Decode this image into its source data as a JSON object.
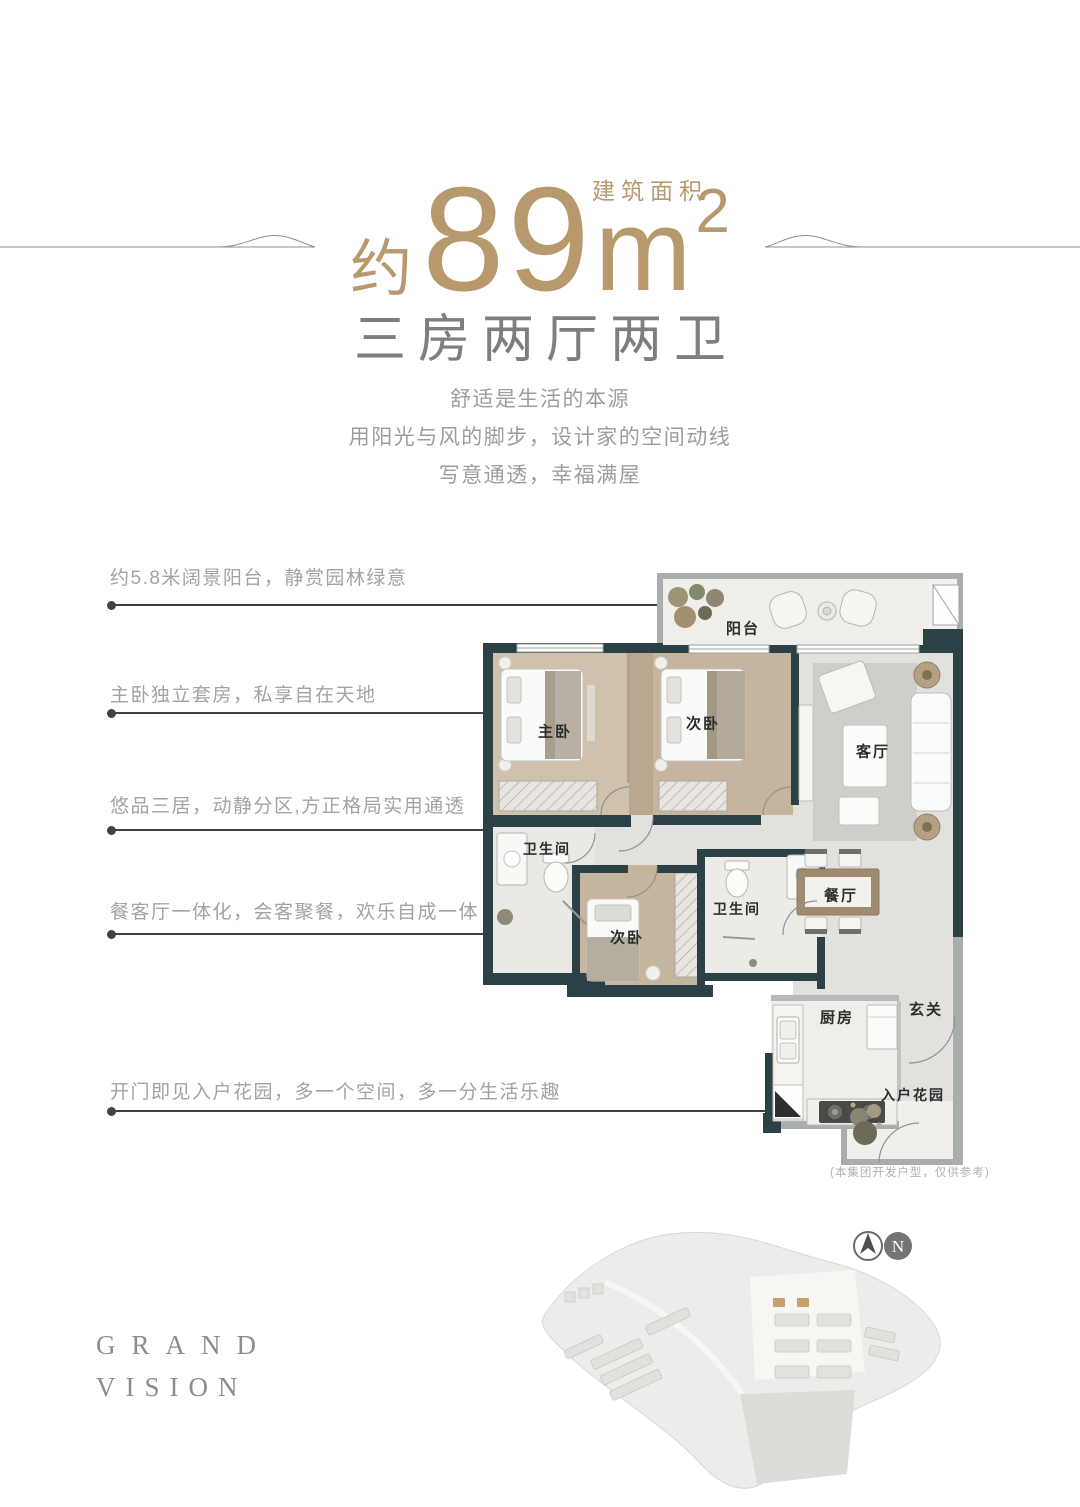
{
  "header": {
    "area_label": "建筑面积",
    "area_prefix": "约",
    "area_number": "89",
    "area_unit": "m",
    "area_sup": "2",
    "title": "三房两厅两卫",
    "subtitle_lines": [
      "舒适是生活的本源",
      "用阳光与风的脚步，设计家的空间动线",
      "写意通透，幸福满屋"
    ]
  },
  "callouts": [
    {
      "text": "约5.8米阔景阳台，静赏园林绿意"
    },
    {
      "text": "主卧独立套房，私享自在天地"
    },
    {
      "text": "悠品三居，动静分区,方正格局实用通透"
    },
    {
      "text": "餐客厅一体化，会客聚餐，欢乐自成一体"
    },
    {
      "text": "开门即见入户花园，多一个空间，多一分生活乐趣"
    }
  ],
  "floorplan": {
    "rooms": [
      {
        "label": "阳台"
      },
      {
        "label": "主卧"
      },
      {
        "label": "次卧"
      },
      {
        "label": "客厅"
      },
      {
        "label": "卫生间"
      },
      {
        "label": "次卧"
      },
      {
        "label": "卫生间"
      },
      {
        "label": "餐厅"
      },
      {
        "label": "厨房"
      },
      {
        "label": "玄关"
      },
      {
        "label": "入户花园"
      }
    ],
    "note": "(本集团开发户型，仅供参考)"
  },
  "footer": {
    "brand_line1": "GRAND",
    "brand_line2": "VISION",
    "compass_n": "N"
  },
  "colors": {
    "gold": "#b7996d",
    "heading_gray": "#7e7e7e",
    "body_gray": "#9d9d9d",
    "wall_dark": "#2b4145"
  }
}
